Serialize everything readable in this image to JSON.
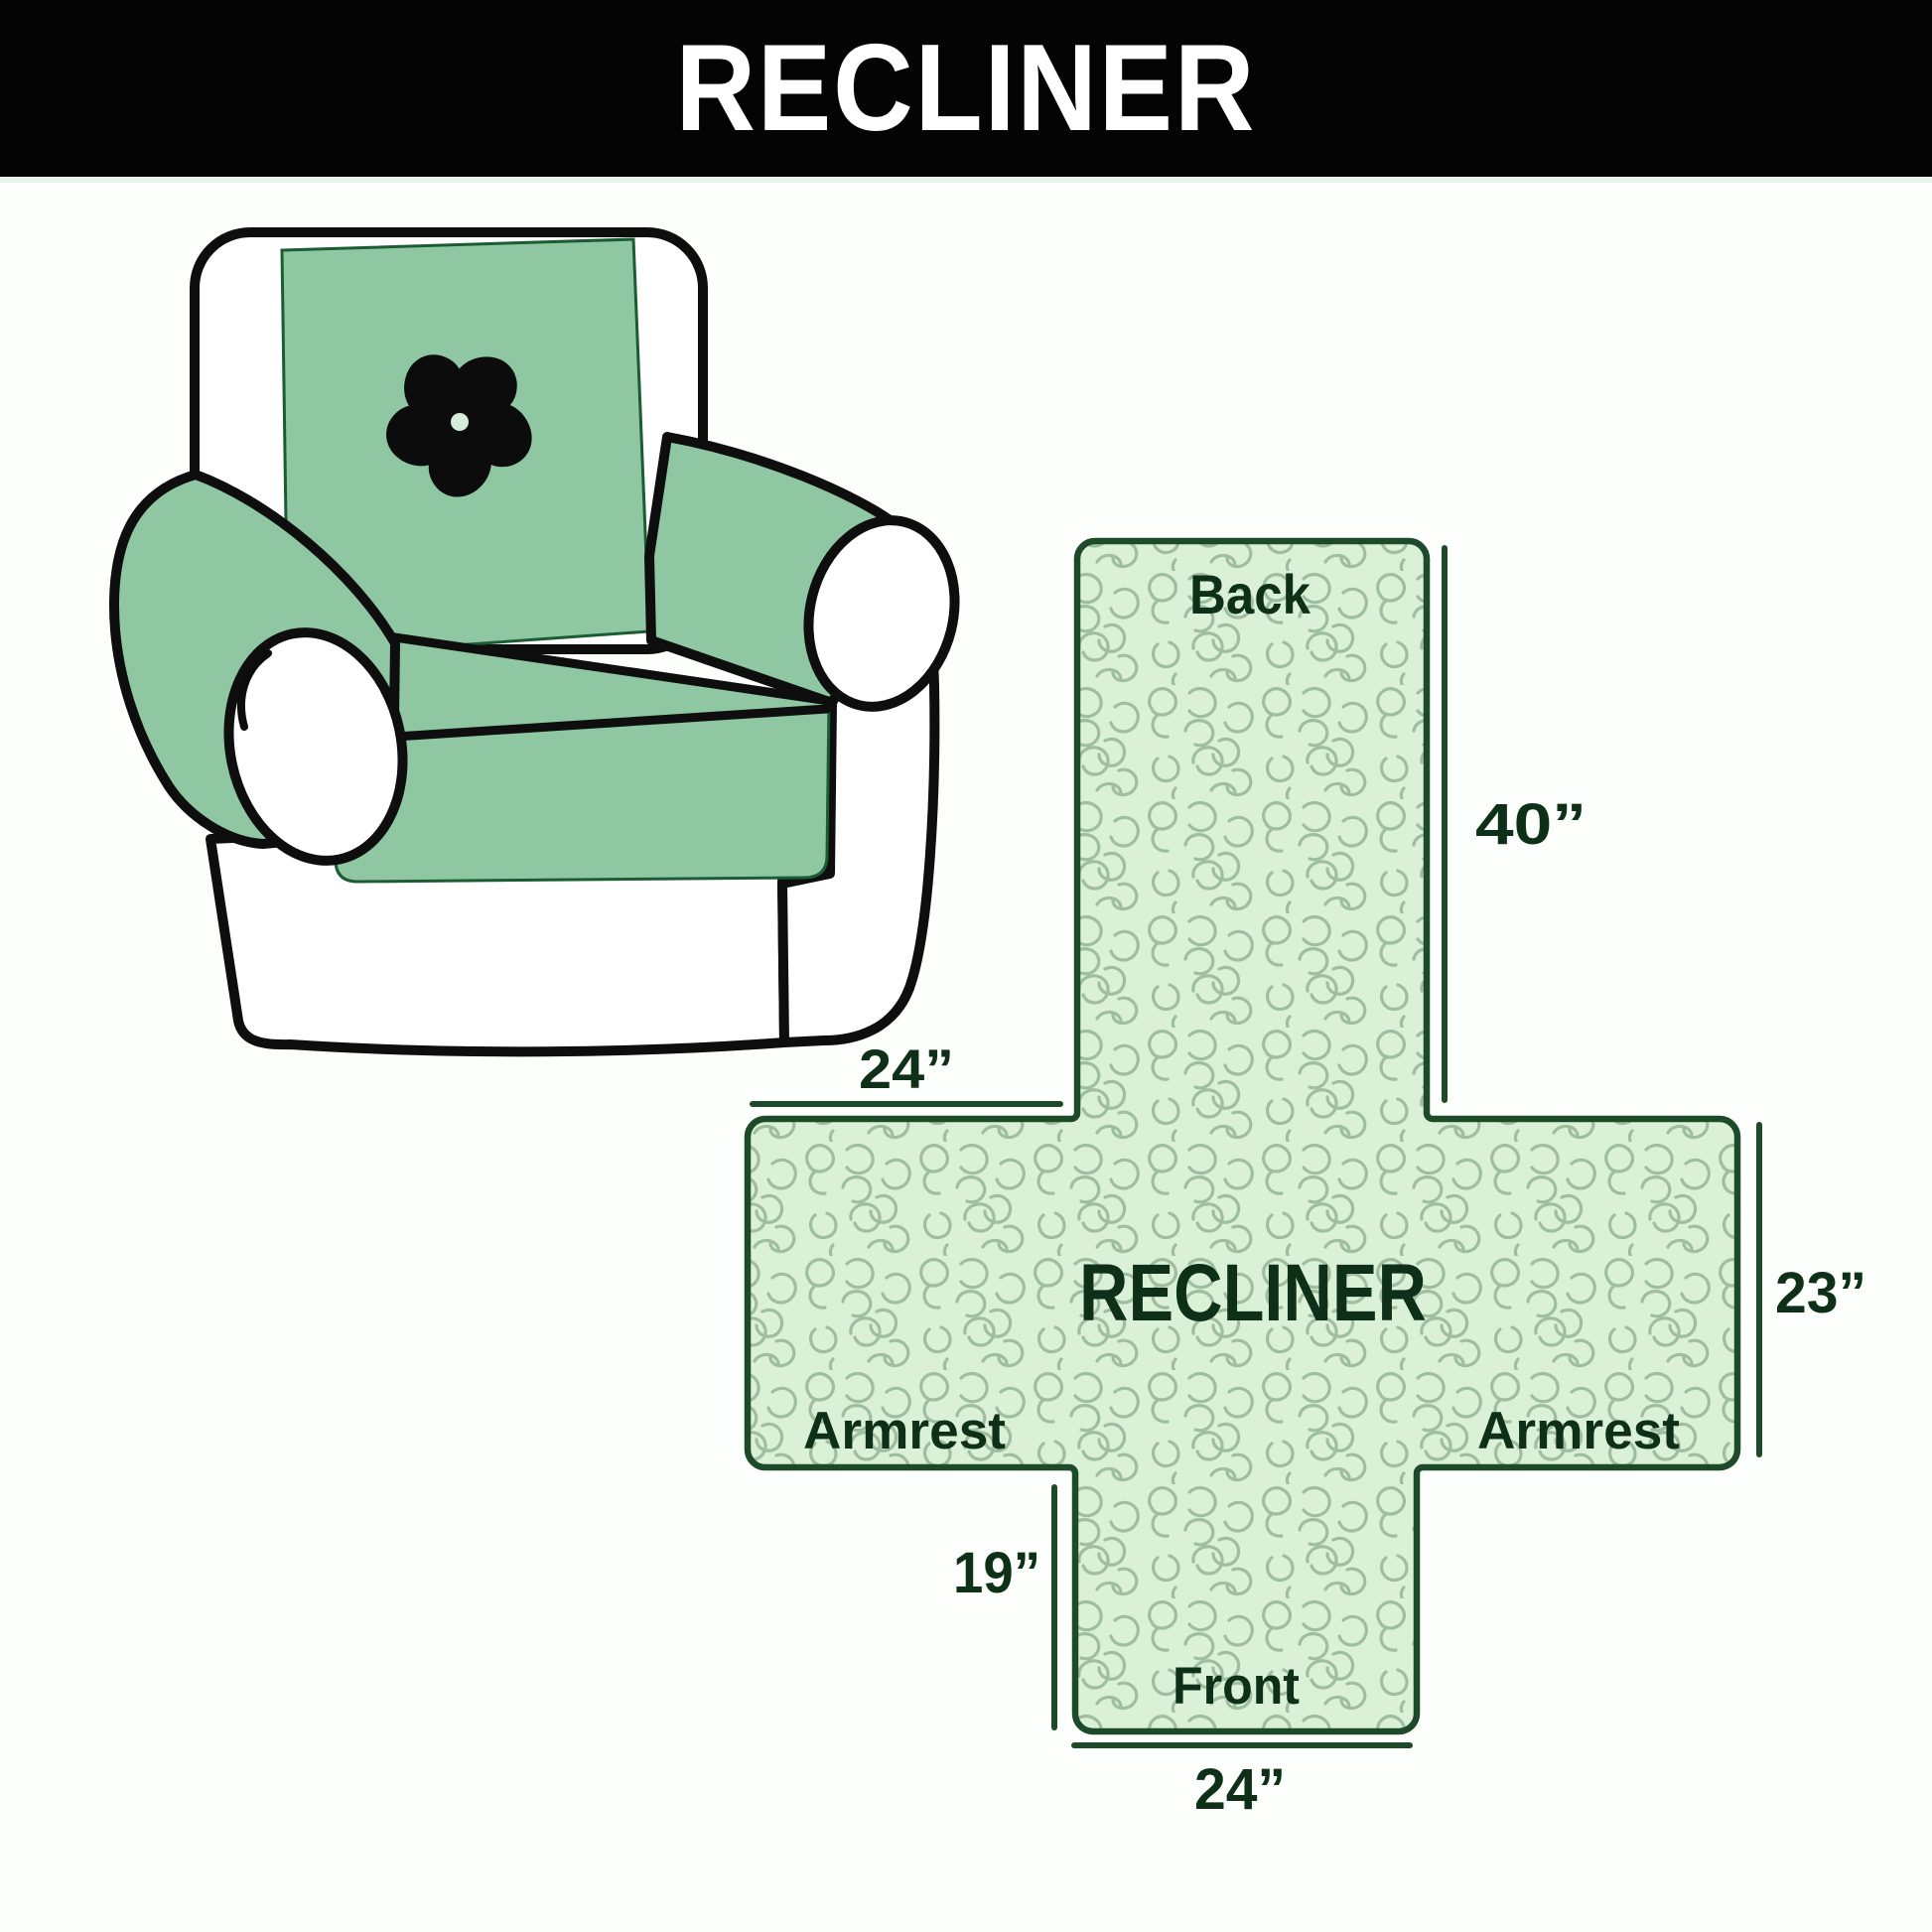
{
  "header": {
    "title": "RECLINER",
    "bg_color": "#040404",
    "text_color": "#ffffff"
  },
  "chair": {
    "description": "armchair with quilted protector cover",
    "cover_color": "#8fc7a3",
    "outline_color": "#0e0e0e",
    "logo": "pinwheel-fan"
  },
  "diagram": {
    "shape": "cross cover layout",
    "fill_color": "#daf0d7",
    "pattern_color": "#9fbe9f",
    "outline_color": "#1d4a29",
    "text_color": "#0e3018",
    "center_label": "RECLINER",
    "labels": {
      "back": "Back",
      "armrest_left": "Armrest",
      "armrest_right": "Armrest",
      "front": "Front"
    },
    "dimensions": {
      "back_height": "40”",
      "armrest_top_width": "24”",
      "side_height": "23”",
      "front_flap_height": "19”",
      "front_width": "24”"
    }
  }
}
